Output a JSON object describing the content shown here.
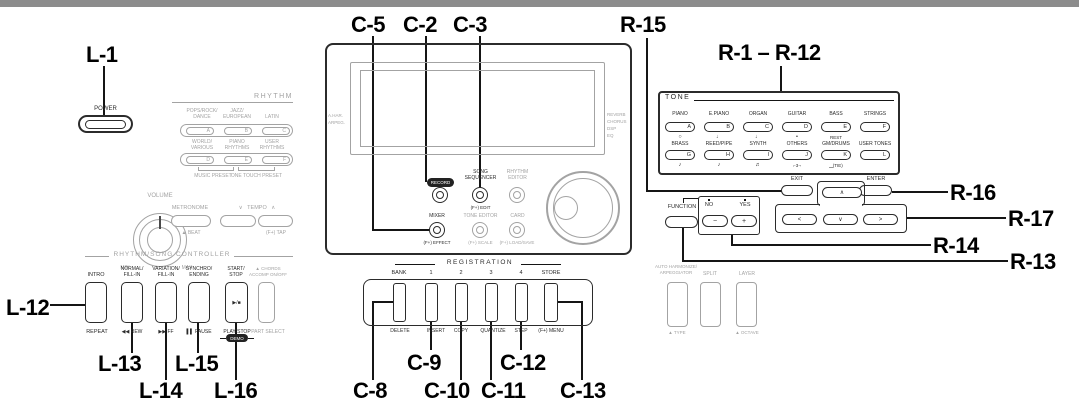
{
  "colors": {
    "ink": "#2b2b2b",
    "muted": "#a3a3a3",
    "top_edge": "#8c8c8c"
  },
  "callouts": {
    "l1": "L-1",
    "l12": "L-12",
    "l13": "L-13",
    "l14": "L-14",
    "l15": "L-15",
    "l16": "L-16",
    "c2": "C-2",
    "c3": "C-3",
    "c5": "C-5",
    "c8": "C-8",
    "c9": "C-9",
    "c10": "C-10",
    "c11": "C-11",
    "c12": "C-12",
    "c13": "C-13",
    "r15": "R-15",
    "r1_12": "R-1 – R-12",
    "r16": "R-16",
    "r17": "R-17",
    "r14": "R-14",
    "r13": "R-13"
  },
  "left": {
    "power": "POWER",
    "volume": {
      "label": "VOLUME",
      "min": "MIN",
      "max": "MAX"
    },
    "rhythm": {
      "header": "RHYTHM",
      "row1": [
        {
          "name": "POPS/ROCK/\nDANCE",
          "key": "A"
        },
        {
          "name": "JAZZ/\nEUROPEAN",
          "key": "B"
        },
        {
          "name": "LATIN",
          "key": "C"
        }
      ],
      "row2": [
        {
          "name": "WORLD/\nVARIOUS",
          "key": "D"
        },
        {
          "name": "PIANO\nRHYTHMS",
          "key": "E"
        },
        {
          "name": "USER\nRHYTHMS",
          "key": "F"
        }
      ],
      "preset1": "MUSIC PRESET",
      "preset2": "ONE TOUCH PRESET"
    },
    "metronome": {
      "label": "METRONOME",
      "sub": "▲ BEAT"
    },
    "tempo": {
      "header": "∨   TEMPO   ∧",
      "sub": "(F+) TAP"
    },
    "controller": {
      "header": "RHYTHM/SONG CONTROLLER",
      "buttons": [
        {
          "top": "INTRO",
          "bottom": "REPEAT"
        },
        {
          "top": "NORMAL/\nFILL-IN",
          "bottom": "◀◀ REW"
        },
        {
          "top": "VARIATION/\nFILL-IN",
          "bottom": "▶▶ FF"
        },
        {
          "top": "SYNCHRO/\nENDING",
          "bottom": "▌▌ PAUSE"
        },
        {
          "top": "START/\nSTOP",
          "face": "▶/■",
          "bottom": "PLAY/STOP",
          "demo": "DEMO"
        },
        {
          "top": "▲ CHORDS\nACCOMP ON/OFF",
          "bottom": "PART SELECT"
        }
      ]
    }
  },
  "center": {
    "display": {
      "left": "A.HAR.\nARPEG.",
      "right": "REVERB\nCHORUS\nDSP\nEQ"
    },
    "record": "RECORD",
    "song_sequencer": {
      "label": "SONG\nSEQUENCER",
      "sub": "(F+) EDIT"
    },
    "rhythm_editor": "RHYTHM\nEDITOR",
    "mixer": {
      "label": "MIXER",
      "sub": "(F+) EFFECT"
    },
    "tone_editor": {
      "label": "TONE EDITOR",
      "sub": "(F+) SCALE"
    },
    "card": {
      "label": "CARD",
      "sub": "(F+) LOAD/SAVE"
    },
    "registration": {
      "header": "REGISTRATION",
      "buttons": [
        {
          "top": "BANK",
          "bottom": "DELETE"
        },
        {
          "top": "1",
          "bottom": "INSERT"
        },
        {
          "top": "2",
          "bottom": "COPY"
        },
        {
          "top": "3",
          "bottom": "QUANTIZE"
        },
        {
          "top": "4",
          "bottom": "STEP"
        },
        {
          "top": "STORE",
          "bottom": "(F+) MENU"
        }
      ]
    }
  },
  "right": {
    "tone": {
      "header": "TONE",
      "row1": [
        {
          "name": "PIANO",
          "key": "A",
          "note": "○"
        },
        {
          "name": "E.PIANO",
          "key": "B",
          "note": "♩"
        },
        {
          "name": "ORGAN",
          "key": "C",
          "note": "♩"
        },
        {
          "name": "GUITAR",
          "key": "D",
          "note": "•"
        },
        {
          "name": "BASS",
          "key": "E"
        },
        {
          "name": "STRINGS",
          "key": "F"
        }
      ],
      "row2": [
        {
          "name": "BRASS",
          "key": "G",
          "note": "♪"
        },
        {
          "name": "REED/PIPE",
          "key": "H",
          "note": "♪"
        },
        {
          "name": "SYNTH",
          "key": "I",
          "note": "♬"
        },
        {
          "name": "OTHERS",
          "key": "J",
          "note": "⌐3¬"
        },
        {
          "name": "GM/DRUMS",
          "key": "K",
          "note": "‿(TIE)",
          "above": "REST"
        },
        {
          "name": "USER TONES",
          "key": "L"
        }
      ]
    },
    "exit": "EXIT",
    "enter": "ENTER",
    "pad": {
      "up": "∧",
      "left": "<",
      "down": "∨",
      "right": ">"
    },
    "function": {
      "label": "FUNCTION"
    },
    "noyes": {
      "no": "NO",
      "yes": "YES",
      "minus": "−",
      "plus": "+"
    },
    "bottom": [
      {
        "label": "AUTO HARMONIZE/\nARPEGGIATOR",
        "sub": "▲ TYPE"
      },
      {
        "label": "SPLIT",
        "sub": ""
      },
      {
        "label": "LAYER",
        "sub": "▲ OCTAVE"
      }
    ]
  }
}
